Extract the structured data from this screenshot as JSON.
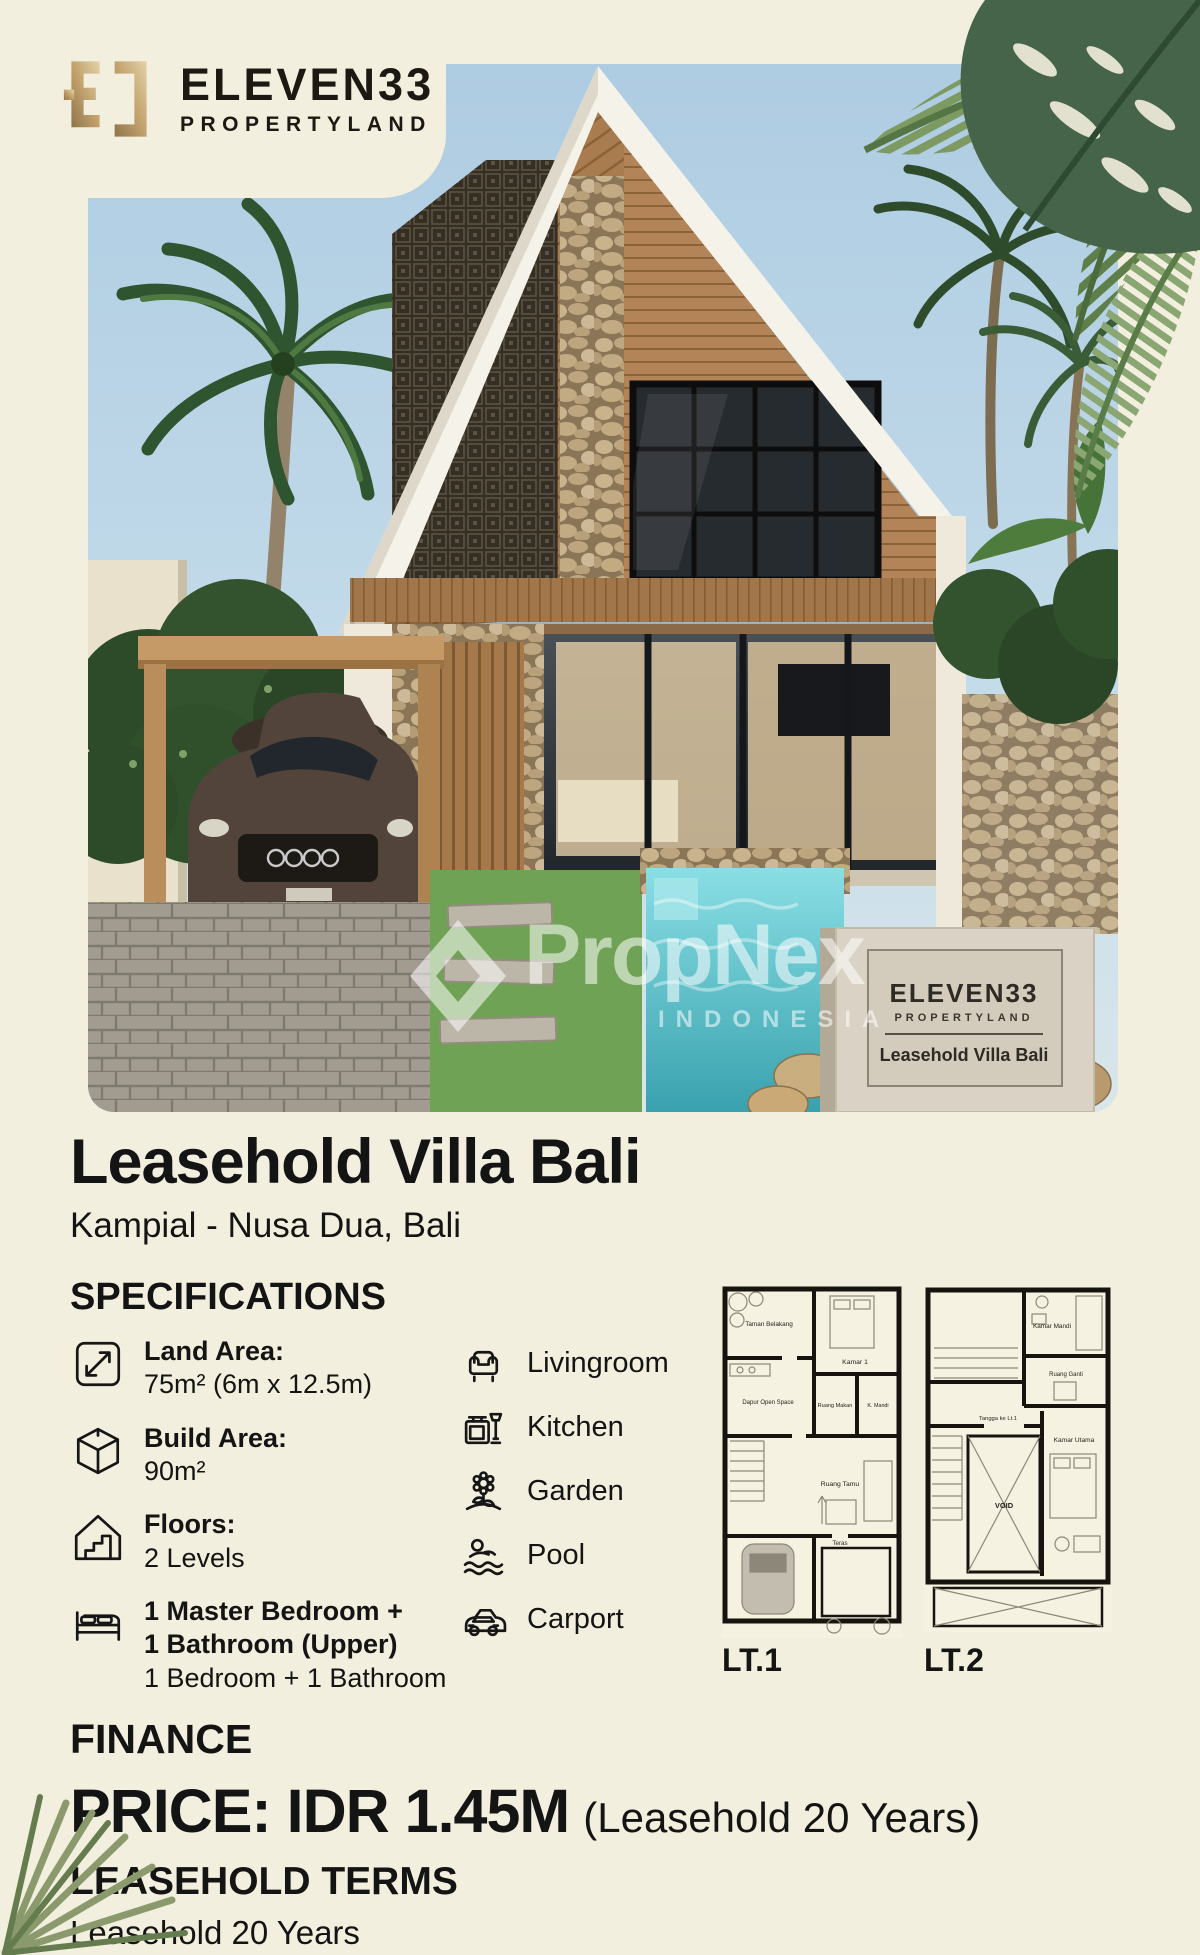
{
  "brand": {
    "name": "ELEVEN33",
    "tagline": "PROPERTYLAND"
  },
  "photo": {
    "watermark": {
      "name": "PropNex",
      "country": "INDONESIA"
    },
    "sign": {
      "brand": "ELEVEN33",
      "tagline": "PROPERTYLAND",
      "label": "Leasehold Villa Bali"
    }
  },
  "listing": {
    "title": "Leasehold Villa Bali",
    "location": "Kampial - Nusa Dua, Bali"
  },
  "specs": {
    "heading": "SPECIFICATIONS",
    "details": [
      {
        "icon": "land-area-icon",
        "label": "Land Area:",
        "value": "75m² (6m x 12.5m)"
      },
      {
        "icon": "build-area-icon",
        "label": "Build Area:",
        "value": "90m²"
      },
      {
        "icon": "floors-icon",
        "label": "Floors:",
        "value": "2 Levels"
      },
      {
        "icon": "bedroom-icon",
        "label": "1 Master Bedroom +",
        "value": "1 Bathroom (Upper)",
        "extra": "1 Bedroom + 1 Bathroom"
      }
    ],
    "amenities": [
      {
        "icon": "livingroom-icon",
        "label": "Livingroom"
      },
      {
        "icon": "kitchen-icon",
        "label": "Kitchen"
      },
      {
        "icon": "garden-icon",
        "label": "Garden"
      },
      {
        "icon": "pool-icon",
        "label": "Pool"
      },
      {
        "icon": "carport-icon",
        "label": "Carport"
      }
    ]
  },
  "floorplans": {
    "plan1": {
      "label": "LT.1",
      "rooms": {
        "garden": "Taman Belakang",
        "bedroom": "Kamar 1",
        "kitchen": "Dapur Open Space",
        "dining": "Ruang Makan",
        "bath": "K. Mandi",
        "living": "Ruang Tamu",
        "terrace": "Teras"
      }
    },
    "plan2": {
      "label": "LT.2",
      "rooms": {
        "bath": "Kamar Mandi",
        "wardrobe": "Ruang Ganti",
        "stairs": "Tangga ke Lt.1",
        "master": "Kamar Utama",
        "void": "VOID"
      }
    }
  },
  "finance": {
    "heading": "FINANCE",
    "price": "PRICE: IDR 1.45M",
    "price_note": "(Leasehold 20 Years)"
  },
  "terms": {
    "heading": "LEASEHOLD TERMS",
    "value": "Leasehold 20 Years"
  },
  "colors": {
    "background": "#f3efde",
    "text": "#141414",
    "gold": "#c2a26d",
    "sky": "#b9d4e5",
    "pool": "#54c0cb",
    "lawn": "#6fa254",
    "wood": "#b08457",
    "leaf_dark": "#2c4b2e",
    "leaf_sage": "#7d9a62"
  }
}
